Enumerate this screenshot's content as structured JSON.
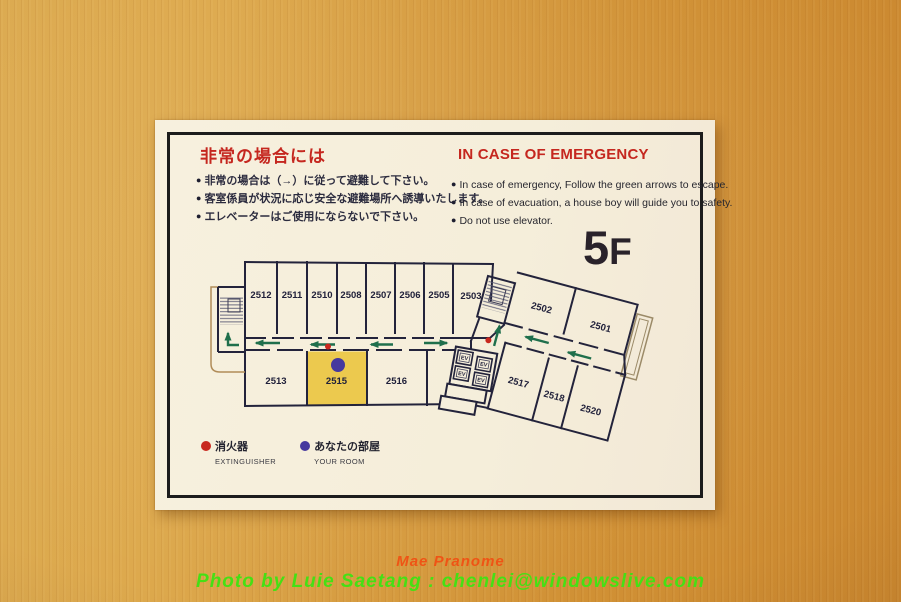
{
  "photo": {
    "watermark": {
      "line1": "Mae Pranome",
      "line2": "Photo by Luie Saetang : chenlei@windowslive.com"
    }
  },
  "sign": {
    "bullet_glyph": "●",
    "jp": {
      "title": "非常の場合には",
      "bullets": [
        "非常の場合は（→）に従って避難して下さい。",
        "客室係員が状況に応じ安全な避難場所へ誘導いたします。",
        "エレベーターはご使用にならないで下さい。"
      ]
    },
    "en": {
      "title": "IN CASE OF EMERGENCY",
      "bullets": [
        "In case of emergency, Follow the green arrows to escape.",
        "In case of evacuation, a house boy will guide you to safety.",
        "Do not use elevator."
      ]
    },
    "floor": {
      "digit": "5",
      "letter": "F"
    },
    "plan": {
      "top_rooms": [
        "2512",
        "2511",
        "2510",
        "2508",
        "2507",
        "2506",
        "2505",
        "2503"
      ],
      "bottom_rooms": [
        "2513",
        "2515",
        "2516"
      ],
      "right_top_rooms": [
        "2502",
        "2501"
      ],
      "right_bottom_rooms": [
        "2517",
        "2518",
        "2520"
      ],
      "elevator_label": "EV",
      "highlighted_room": "2515"
    },
    "legend": [
      {
        "jp": "消火器",
        "en": "EXTINGUISHER"
      },
      {
        "jp": "あなたの部屋",
        "en": "YOUR ROOM"
      }
    ],
    "colors": {
      "title_red": "#c5271f",
      "wall_navy": "#23233b",
      "arrow_green": "#1f6f4c",
      "highlight_yellow": "#ecc94e",
      "extinguisher_red": "#c8281e",
      "your_room_blue": "#46399e",
      "card_cream": "#f5eedb",
      "wood_orange": "#d2953d"
    }
  }
}
